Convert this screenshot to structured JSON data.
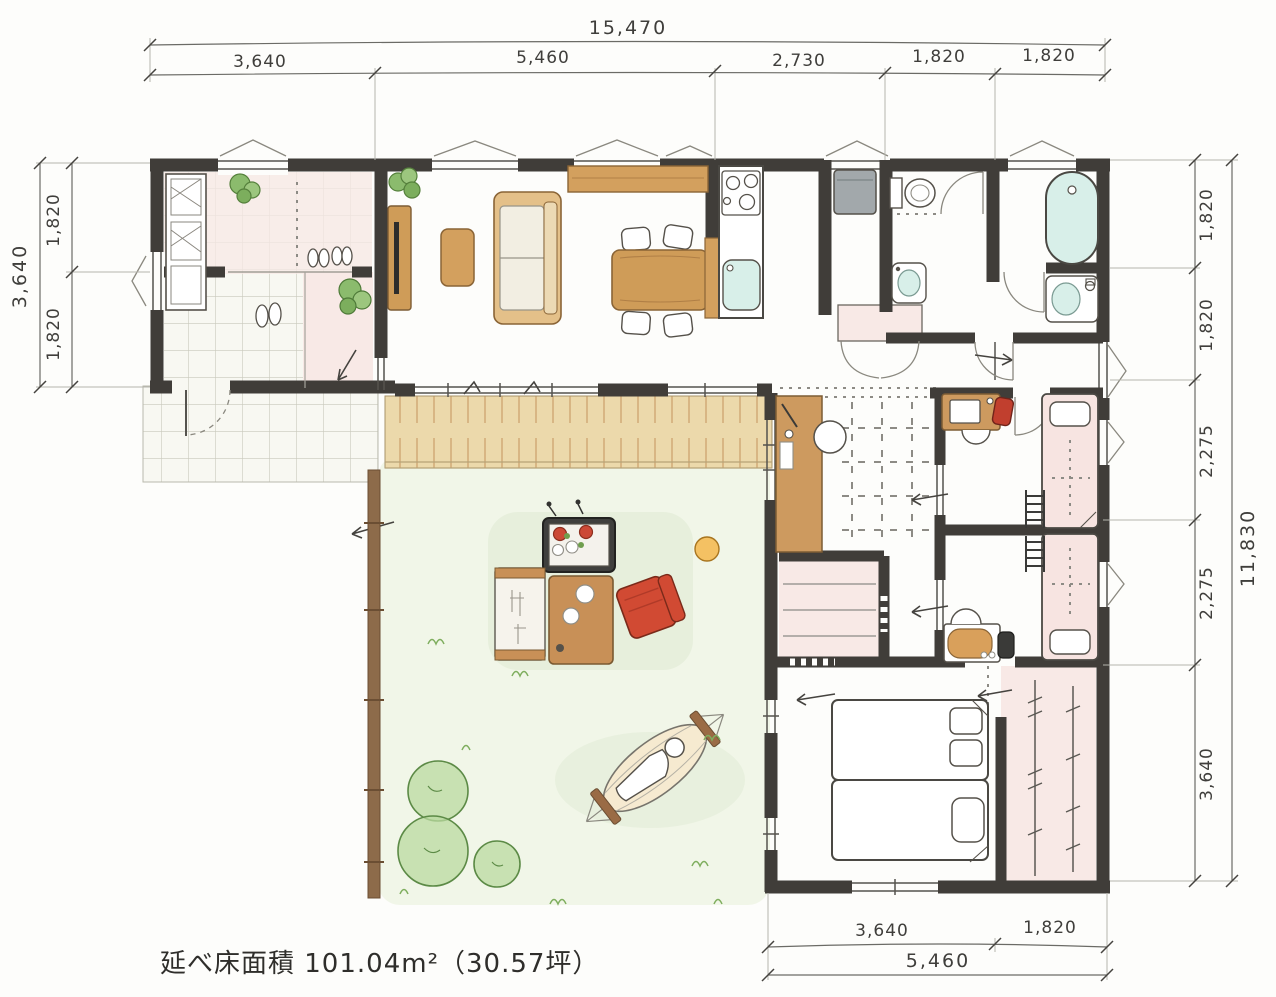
{
  "drawing": {
    "type": "hand-drawn house floor plan (single story, L-shaped, with courtyard deck and garden)",
    "units": "mm"
  },
  "dimensions": {
    "top_total": "15,470",
    "top_segments": [
      "3,640",
      "5,460",
      "2,730",
      "1,820",
      "1,820"
    ],
    "left_total": "3,640",
    "left_segments": [
      "1,820",
      "1,820"
    ],
    "right_total": "11,830",
    "right_segments": [
      "1,820",
      "1,820",
      "2,275",
      "2,275",
      "3,640"
    ],
    "bottom_segments": [
      "3,640",
      "1,820"
    ],
    "bottom_total": "5,460"
  },
  "footer": {
    "floor_area_text": "延べ床面積 101.04m²（30.57坪）"
  },
  "colors": {
    "wall": "#403d39",
    "room_pink": "#f8e9e6",
    "wood_furniture": "#cf9c58",
    "deck": "#ecd9ab",
    "tile_line": "#c9c9bc",
    "water_mint": "#d8efe9",
    "garden_wash": "#edf4e3",
    "plant_green": "#8bbb6d",
    "accent_red": "#cf4733",
    "appliance_gray": "#a2a8ab",
    "fence_brown": "#8d6b4a"
  }
}
